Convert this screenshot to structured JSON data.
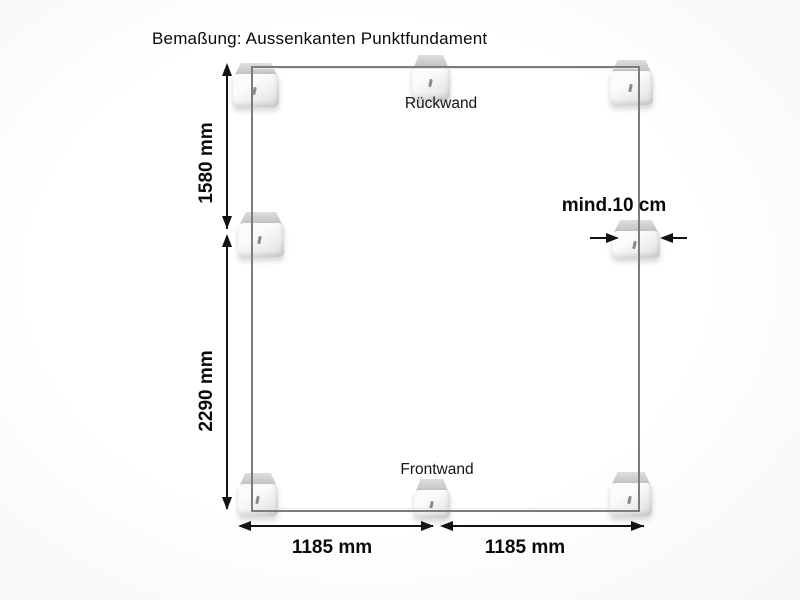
{
  "title": "Bemaßung: Aussenkanten Punktfundament",
  "walls": {
    "back": "Rückwand",
    "front": "Frontwand"
  },
  "dimensions": {
    "side_upper": "1580 mm",
    "side_lower": "2290 mm",
    "front_left": "1185 mm",
    "front_right": "1185 mm",
    "block_min_width": "mind.10 cm"
  },
  "foundation_blocks": [
    "top-left",
    "top-center",
    "top-right",
    "middle-left",
    "middle-right",
    "bottom-left",
    "bottom-center",
    "bottom-right"
  ],
  "colors": {
    "background": "#ffffff",
    "outline": "#7c7c7c",
    "dimension_lines": "#121212",
    "text": "#000000",
    "block_top_face": "#c9c9c9",
    "block_front_face": "#f2f2f2"
  }
}
